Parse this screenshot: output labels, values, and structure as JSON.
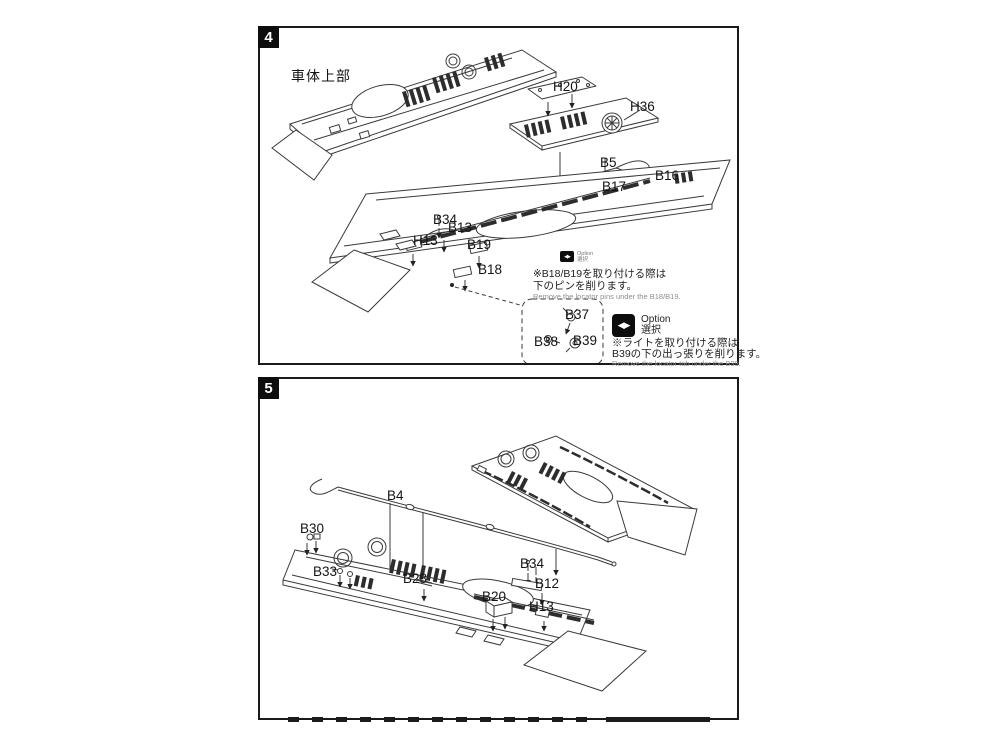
{
  "page": {
    "background": "#ffffff",
    "line_color": "#3a3a3a",
    "accent_black": "#0d0d0d"
  },
  "step4": {
    "number": "4",
    "heading": "車体上部",
    "part_labels": [
      {
        "text": "H20",
        "x": 293,
        "y": 51
      },
      {
        "text": "H36",
        "x": 370,
        "y": 71
      },
      {
        "text": "B5",
        "x": 340,
        "y": 127
      },
      {
        "text": "B16",
        "x": 395,
        "y": 140
      },
      {
        "text": "B17",
        "x": 342,
        "y": 151
      },
      {
        "text": "B34",
        "x": 173,
        "y": 184
      },
      {
        "text": "B13",
        "x": 188,
        "y": 192
      },
      {
        "text": "H13",
        "x": 153,
        "y": 205
      },
      {
        "text": "B19",
        "x": 207,
        "y": 209
      },
      {
        "text": "B18",
        "x": 218,
        "y": 234
      },
      {
        "text": "B37",
        "x": 305,
        "y": 279
      },
      {
        "text": "B38",
        "x": 274,
        "y": 306
      },
      {
        "text": "B39",
        "x": 313,
        "y": 305
      }
    ],
    "note_b18": {
      "icon": "option-toggle-icon",
      "icon_glyph": "◀▶",
      "caption_en": "Option",
      "caption_jp": "選択",
      "jp_line1": "※B18/B19を取り付ける際は",
      "jp_line2": "下のピンを削ります。",
      "en": "Remove the locator pins under the B18/B19."
    },
    "note_b39": {
      "icon": "option-toggle-icon",
      "icon_glyph": "◀▶",
      "caption_en": "Option",
      "caption_jp": "選択",
      "jp_line1": "※ライトを取り付ける際は",
      "jp_line2": "B39の下の出っ張りを削ります。",
      "en": "Remove the locator tab under the B39."
    }
  },
  "step5": {
    "number": "5",
    "part_labels": [
      {
        "text": "B4",
        "x": 127,
        "y": 109
      },
      {
        "text": "B30",
        "x": 40,
        "y": 142
      },
      {
        "text": "B33",
        "x": 53,
        "y": 185
      },
      {
        "text": "B28",
        "x": 143,
        "y": 192
      },
      {
        "text": "B34",
        "x": 260,
        "y": 177
      },
      {
        "text": "B12",
        "x": 275,
        "y": 197
      },
      {
        "text": "B20",
        "x": 222,
        "y": 210
      },
      {
        "text": "H13",
        "x": 269,
        "y": 220
      }
    ]
  }
}
